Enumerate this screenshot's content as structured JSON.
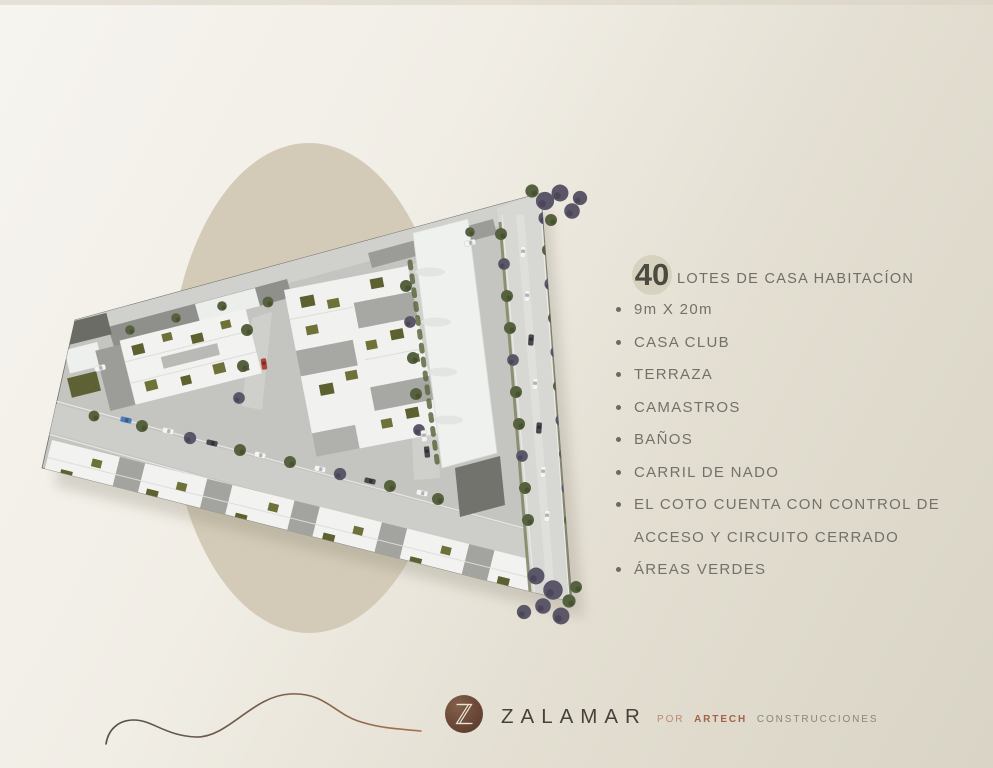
{
  "slide": {
    "headline": {
      "number": "40",
      "text": "LOTES DE CASA HABITACÍON"
    },
    "features": [
      "9m X 20m",
      "CASA CLUB",
      "TERRAZA",
      "CAMASTROS",
      "BAÑOS",
      "CARRIL DE NADO",
      "EL COTO CUENTA CON CONTROL DE ACCESO Y CIRCUITO CERRADO",
      "ÁREAS VERDES"
    ],
    "footer": {
      "monogram": "Z",
      "brand": "ZALAMAR",
      "byline_prefix": "POR",
      "byline_brand": "ARTECH",
      "byline_suffix": "CONSTRUCCIONES"
    },
    "colors": {
      "background_top": "#f6f4ef",
      "background_bottom": "#d9d4c5",
      "circle_beige": "#d3cbb7",
      "text_gray": "#72726a",
      "brand_dark": "#454239",
      "copper_accent": "#a2634a",
      "logo_brown": "#63422f"
    }
  }
}
